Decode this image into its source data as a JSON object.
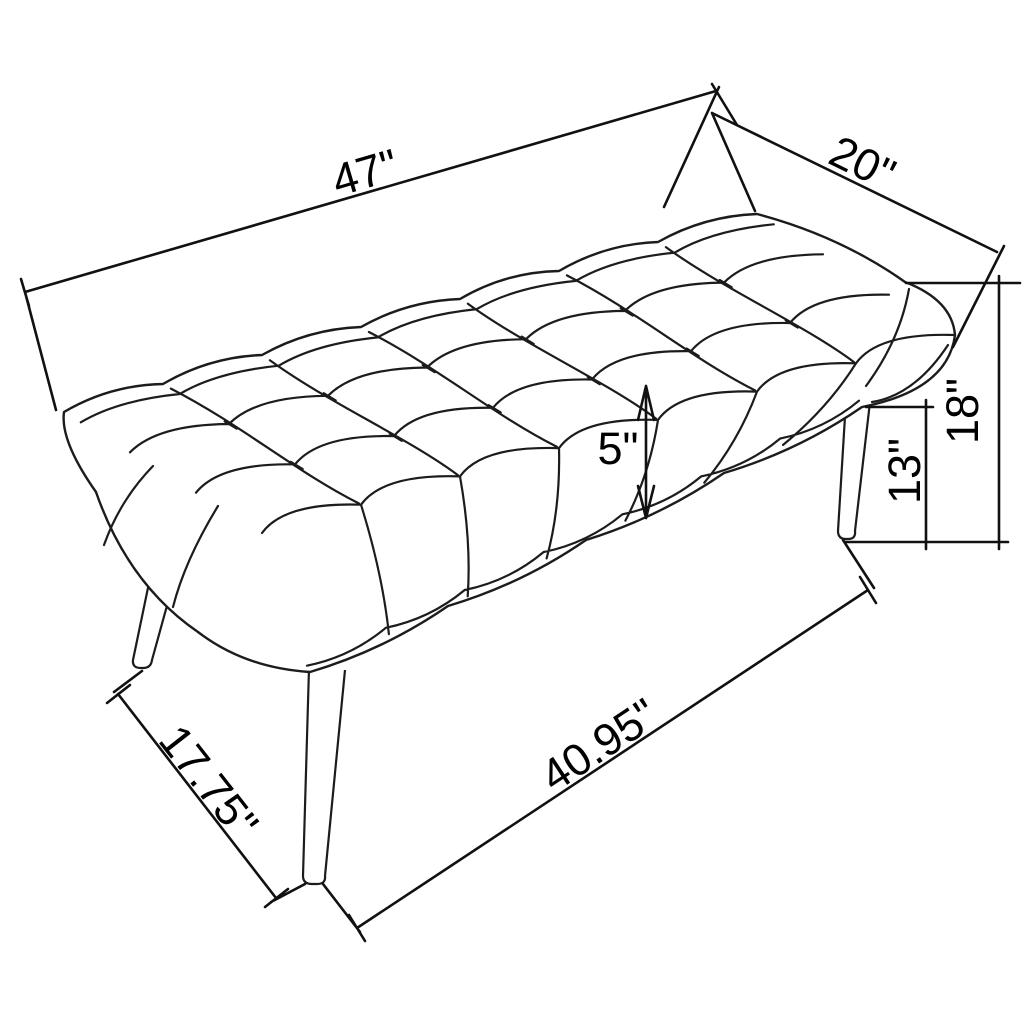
{
  "dimensions": {
    "top_length": "47\"",
    "top_depth": "20\"",
    "overall_height": "18\"",
    "leg_height": "13\"",
    "cushion_thickness": "5\"",
    "base_length": "40.95\"",
    "base_depth": "17.75\""
  }
}
